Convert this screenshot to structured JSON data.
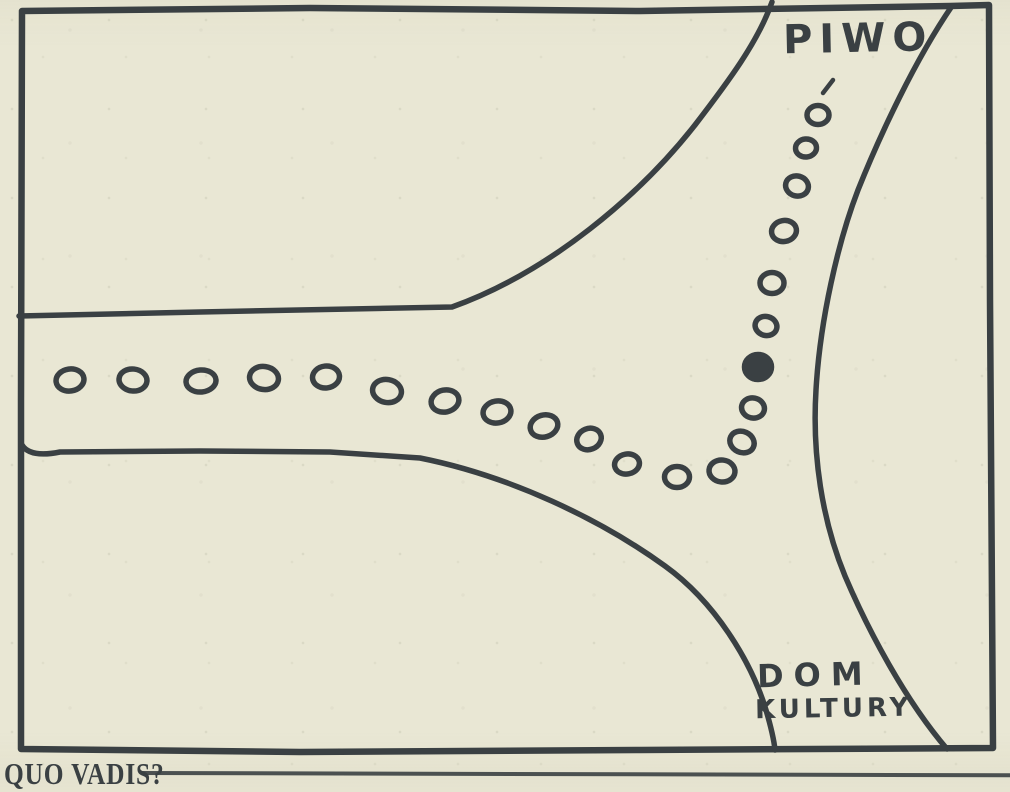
{
  "figure": {
    "type": "hand-drawn road-junction cartoon map",
    "labels": {
      "road_top": "PIWO",
      "road_bottom_line1": "DOM",
      "road_bottom_line2": "KULTURY"
    },
    "caption": "QUO VADIS?",
    "colors": {
      "paper": "#e9e7d4",
      "ink": "#3a4043"
    },
    "trail": {
      "dots": [
        {
          "x": 70,
          "y": 380,
          "rx": 14,
          "ry": 11,
          "rot": -8,
          "filled": false
        },
        {
          "x": 133,
          "y": 380,
          "rx": 14,
          "ry": 11,
          "rot": 6,
          "filled": false
        },
        {
          "x": 201,
          "y": 381,
          "rx": 15,
          "ry": 11,
          "rot": -5,
          "filled": false
        },
        {
          "x": 264,
          "y": 378,
          "rx": 14.5,
          "ry": 11.5,
          "rot": 8,
          "filled": false
        },
        {
          "x": 326,
          "y": 377,
          "rx": 13.5,
          "ry": 11,
          "rot": -6,
          "filled": false
        },
        {
          "x": 387,
          "y": 391,
          "rx": 14.5,
          "ry": 11.5,
          "rot": 10,
          "filled": false
        },
        {
          "x": 445,
          "y": 401,
          "rx": 14,
          "ry": 11,
          "rot": -12,
          "filled": false
        },
        {
          "x": 497,
          "y": 412,
          "rx": 14,
          "ry": 11,
          "rot": -10,
          "filled": false
        },
        {
          "x": 544,
          "y": 426,
          "rx": 14,
          "ry": 11,
          "rot": -16,
          "filled": false
        },
        {
          "x": 589,
          "y": 439,
          "rx": 12.5,
          "ry": 10.5,
          "rot": -22,
          "filled": false
        },
        {
          "x": 627,
          "y": 464,
          "rx": 12.5,
          "ry": 10,
          "rot": -10,
          "filled": false
        },
        {
          "x": 677,
          "y": 477,
          "rx": 12.5,
          "ry": 10.5,
          "rot": 0,
          "filled": false
        },
        {
          "x": 722,
          "y": 471,
          "rx": 13,
          "ry": 11,
          "rot": 6,
          "filled": false
        },
        {
          "x": 742,
          "y": 442,
          "rx": 12.5,
          "ry": 10.5,
          "rot": 25,
          "filled": false
        },
        {
          "x": 753,
          "y": 408,
          "rx": 11.5,
          "ry": 10,
          "rot": 12,
          "filled": false
        },
        {
          "x": 758,
          "y": 367,
          "rx": 13.5,
          "ry": 12.5,
          "rot": 0,
          "filled": true
        },
        {
          "x": 766,
          "y": 326,
          "rx": 11,
          "ry": 9.5,
          "rot": 15,
          "filled": false
        },
        {
          "x": 772,
          "y": 283,
          "rx": 12,
          "ry": 10.5,
          "rot": 0,
          "filled": false
        },
        {
          "x": 784,
          "y": 231,
          "rx": 12.5,
          "ry": 10.5,
          "rot": -10,
          "filled": false
        },
        {
          "x": 797,
          "y": 186,
          "rx": 11.5,
          "ry": 10,
          "rot": 15,
          "filled": false
        },
        {
          "x": 806,
          "y": 148,
          "rx": 10.5,
          "ry": 9,
          "rot": -5,
          "filled": false
        },
        {
          "x": 818,
          "y": 115,
          "rx": 11,
          "ry": 9.5,
          "rot": 0,
          "filled": false
        }
      ],
      "accent_mark": {
        "x1": 823,
        "y1": 93,
        "x2": 833,
        "y2": 80
      }
    }
  }
}
